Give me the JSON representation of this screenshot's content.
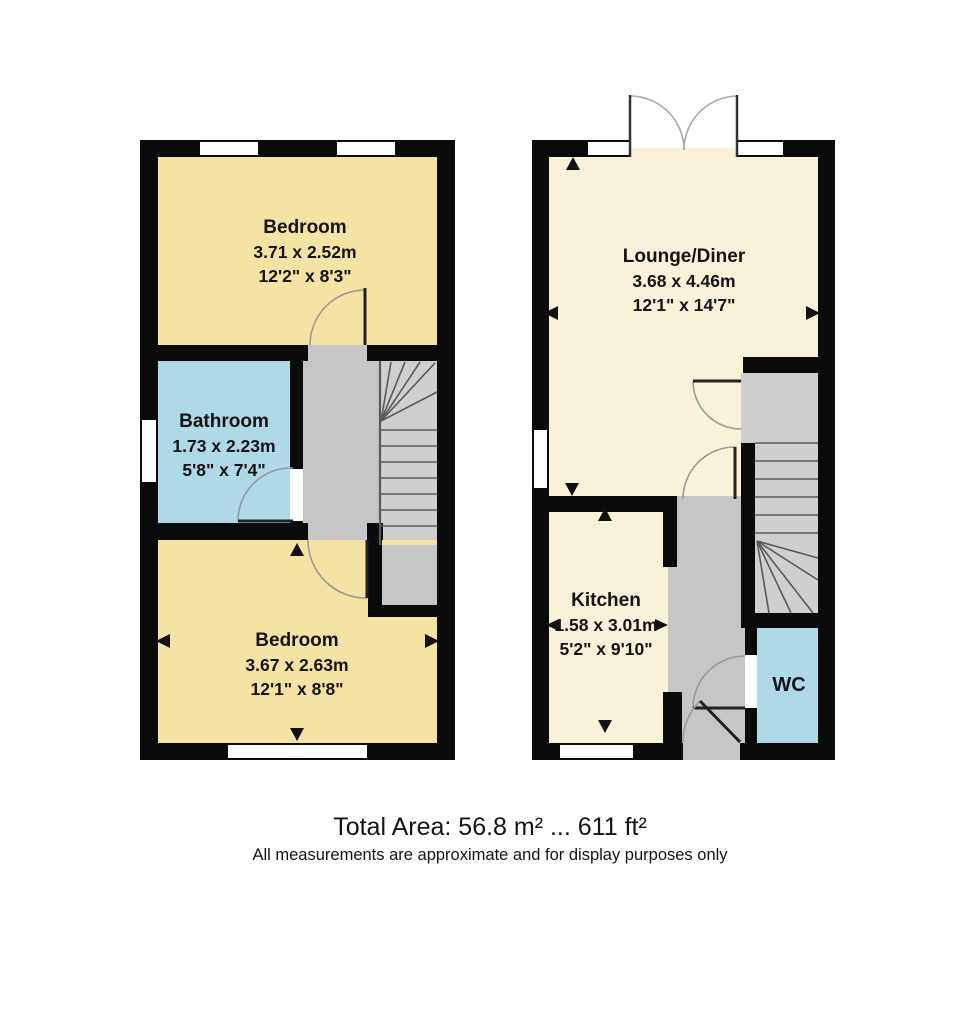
{
  "floorplan": {
    "floors": {
      "first": {
        "rooms": {
          "bedroom1": {
            "name": "Bedroom",
            "metric": "3.71 x 2.52m",
            "imperial": "12'2\" x 8'3\""
          },
          "bathroom": {
            "name": "Bathroom",
            "metric": "1.73 x 2.23m",
            "imperial": "5'8\" x 7'4\""
          },
          "bedroom2": {
            "name": "Bedroom",
            "metric": "3.67 x 2.63m",
            "imperial": "12'1\" x 8'8\""
          }
        }
      },
      "ground": {
        "rooms": {
          "lounge": {
            "name": "Lounge/Diner",
            "metric": "3.68 x 4.46m",
            "imperial": "12'1\" x 14'7\""
          },
          "kitchen": {
            "name": "Kitchen",
            "metric": "1.58 x 3.01m",
            "imperial": "5'2\" x 9'10\""
          },
          "wc": {
            "name": "WC"
          }
        }
      }
    },
    "footer": {
      "total_area": "Total Area: 56.8 m² ... 611 ft²",
      "disclaimer": "All measurements are approximate and for display purposes only"
    },
    "colors": {
      "wall": "#0a0a0a",
      "bedroom_yellow": "#f5e3a4",
      "living_cream": "#f8f2d8",
      "wet_room_blue": "#afd9e6",
      "hall_grey": "#c6c6c6",
      "stair_grey": "#cfcfcf"
    }
  }
}
